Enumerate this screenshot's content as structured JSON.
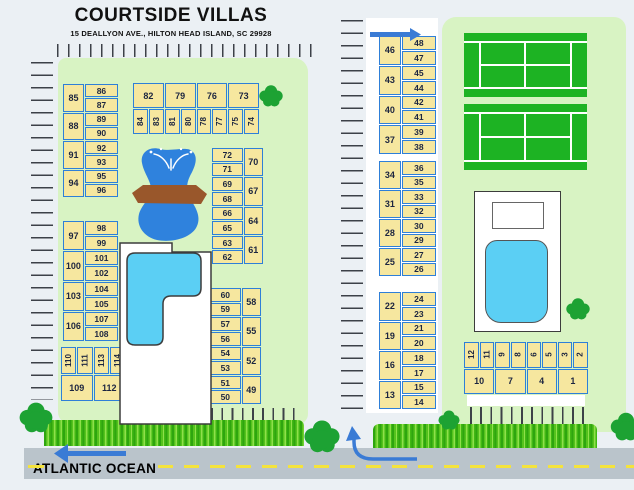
{
  "meta": {
    "title": "COURTSIDE VILLAS",
    "subtitle": "15 DEALLYON AVE., HILTON HEAD ISLAND, SC 29928"
  },
  "ocean": {
    "label": "ATLANTIC OCEAN"
  },
  "colors": {
    "bg": "#ebf0f4",
    "area": "#d8f3c3",
    "unitFill": "#f6e79f",
    "unitBorder": "#2e7fd8",
    "unitText": "#1c2540",
    "tennis": "#1db323",
    "courtLine": "#ffffff",
    "pool": "#5bcff4",
    "fountain": "#2f82dd",
    "bridge": "#99572b",
    "road": "#bac4cb",
    "roadDash": "#f4e33c",
    "arrow": "#3a7bd5",
    "tree": "#1da233",
    "tick": "#3c4148"
  },
  "blocks": [
    {
      "id": "building-85-96",
      "type": "vg-bigleft",
      "x": 63,
      "y": 84,
      "w": 55,
      "h": 113,
      "groups": [
        {
          "big": "85",
          "small": [
            "86",
            "87"
          ]
        },
        {
          "big": "88",
          "small": [
            "89",
            "90"
          ]
        },
        {
          "big": "91",
          "small": [
            "92",
            "93"
          ]
        },
        {
          "big": "94",
          "small": [
            "95",
            "96"
          ]
        }
      ]
    },
    {
      "id": "building-73-84",
      "type": "hz-bigtop",
      "x": 133,
      "y": 83,
      "w": 126,
      "h": 51,
      "top": [
        "82",
        "79",
        "76",
        "73"
      ],
      "bottom": [
        "84",
        "83",
        "81",
        "80",
        "78",
        "77",
        "75",
        "74"
      ]
    },
    {
      "id": "building-61-72",
      "type": "vg-bigright",
      "x": 212,
      "y": 148,
      "w": 51,
      "h": 116,
      "groups": [
        {
          "small": [
            "72",
            "71"
          ],
          "big": "70"
        },
        {
          "small": [
            "69",
            "68"
          ],
          "big": "67"
        },
        {
          "small": [
            "66",
            "65"
          ],
          "big": "64"
        },
        {
          "small": [
            "63",
            "62"
          ],
          "big": "61"
        }
      ]
    },
    {
      "id": "building-97-108",
      "type": "vg-bigleft",
      "x": 63,
      "y": 221,
      "w": 55,
      "h": 120,
      "groups": [
        {
          "big": "97",
          "small": [
            "98",
            "99"
          ]
        },
        {
          "big": "100",
          "small": [
            "101",
            "102"
          ]
        },
        {
          "big": "103",
          "small": [
            "104",
            "105"
          ]
        },
        {
          "big": "106",
          "small": [
            "107",
            "108"
          ]
        }
      ]
    },
    {
      "id": "building-109-120",
      "type": "hz-bigbottom",
      "x": 61,
      "y": 347,
      "w": 129,
      "h": 54,
      "top": [
        "110",
        "111",
        "113",
        "114",
        "116",
        "117",
        "119",
        "120"
      ],
      "bottom": [
        "109",
        "112",
        "115",
        "118"
      ]
    },
    {
      "id": "building-49-60",
      "type": "vg-bigright",
      "x": 210,
      "y": 288,
      "w": 51,
      "h": 116,
      "groups": [
        {
          "small": [
            "60",
            "59"
          ],
          "big": "58"
        },
        {
          "small": [
            "57",
            "56"
          ],
          "big": "55"
        },
        {
          "small": [
            "54",
            "53"
          ],
          "big": "52"
        },
        {
          "small": [
            "51",
            "50"
          ],
          "big": "49"
        }
      ]
    },
    {
      "id": "building-37-48",
      "type": "vg-bigleft",
      "x": 379,
      "y": 36,
      "w": 57,
      "h": 118,
      "groups": [
        {
          "big": "46",
          "small": [
            "48",
            "47"
          ]
        },
        {
          "big": "43",
          "small": [
            "45",
            "44"
          ]
        },
        {
          "big": "40",
          "small": [
            "42",
            "41"
          ]
        },
        {
          "big": "37",
          "small": [
            "39",
            "38"
          ]
        }
      ]
    },
    {
      "id": "building-25-36",
      "type": "vg-bigleft",
      "x": 379,
      "y": 161,
      "w": 57,
      "h": 115,
      "groups": [
        {
          "big": "34",
          "small": [
            "36",
            "35"
          ]
        },
        {
          "big": "31",
          "small": [
            "33",
            "32"
          ]
        },
        {
          "big": "28",
          "small": [
            "30",
            "29"
          ]
        },
        {
          "big": "25",
          "small": [
            "27",
            "26"
          ]
        }
      ]
    },
    {
      "id": "building-13-24",
      "type": "vg-bigleft",
      "x": 379,
      "y": 292,
      "w": 57,
      "h": 117,
      "groups": [
        {
          "big": "22",
          "small": [
            "24",
            "23"
          ]
        },
        {
          "big": "19",
          "small": [
            "21",
            "20"
          ]
        },
        {
          "big": "16",
          "small": [
            "18",
            "17"
          ]
        },
        {
          "big": "13",
          "small": [
            "15",
            "14"
          ]
        }
      ]
    },
    {
      "id": "building-1-12",
      "type": "hz-bigbottom",
      "x": 464,
      "y": 342,
      "w": 124,
      "h": 52,
      "top": [
        "12",
        "11",
        "9",
        "8",
        "6",
        "5",
        "3",
        "2"
      ],
      "bottom": [
        "10",
        "7",
        "4",
        "1"
      ]
    }
  ],
  "trees": [
    {
      "x": 271,
      "y": 97,
      "s": 10
    },
    {
      "x": 578,
      "y": 310,
      "s": 10
    },
    {
      "x": 449,
      "y": 421,
      "s": 9
    },
    {
      "x": 322,
      "y": 438,
      "s": 15
    },
    {
      "x": 36,
      "y": 419,
      "s": 14
    },
    {
      "x": 626,
      "y": 428,
      "s": 13
    }
  ]
}
